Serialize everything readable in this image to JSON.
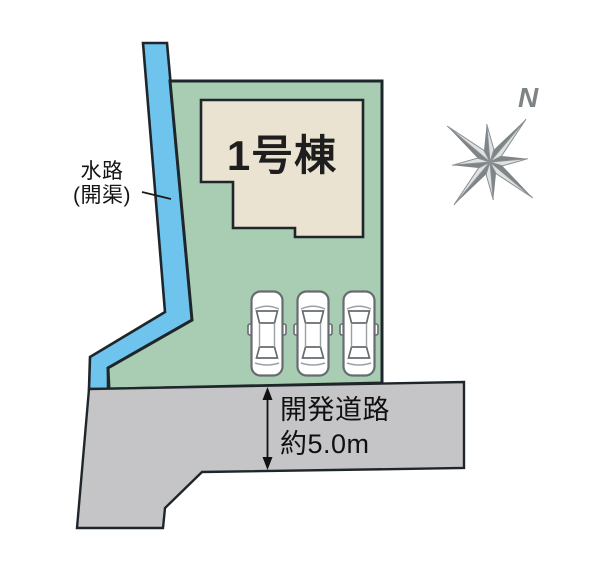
{
  "plan": {
    "type": "real-estate-site-plan",
    "building_count": 1,
    "parking_spaces": 3
  },
  "labels": {
    "waterway_line1": "水路",
    "waterway_line2": "(開渠)",
    "building": "1号棟",
    "road_line1": "開発道路",
    "road_line2": "約5.0m",
    "compass_north": "N"
  },
  "colors": {
    "background": "#ffffff",
    "waterway": "#6fc4ee",
    "plot": "#a8cdb2",
    "building": "#eae3d1",
    "road": "#c5c4c7",
    "outline": "#1f262b",
    "car_stroke": "#676c70",
    "compass_dark": "#7f8487",
    "compass_light": "#dfe2e3",
    "text": "#141414"
  }
}
